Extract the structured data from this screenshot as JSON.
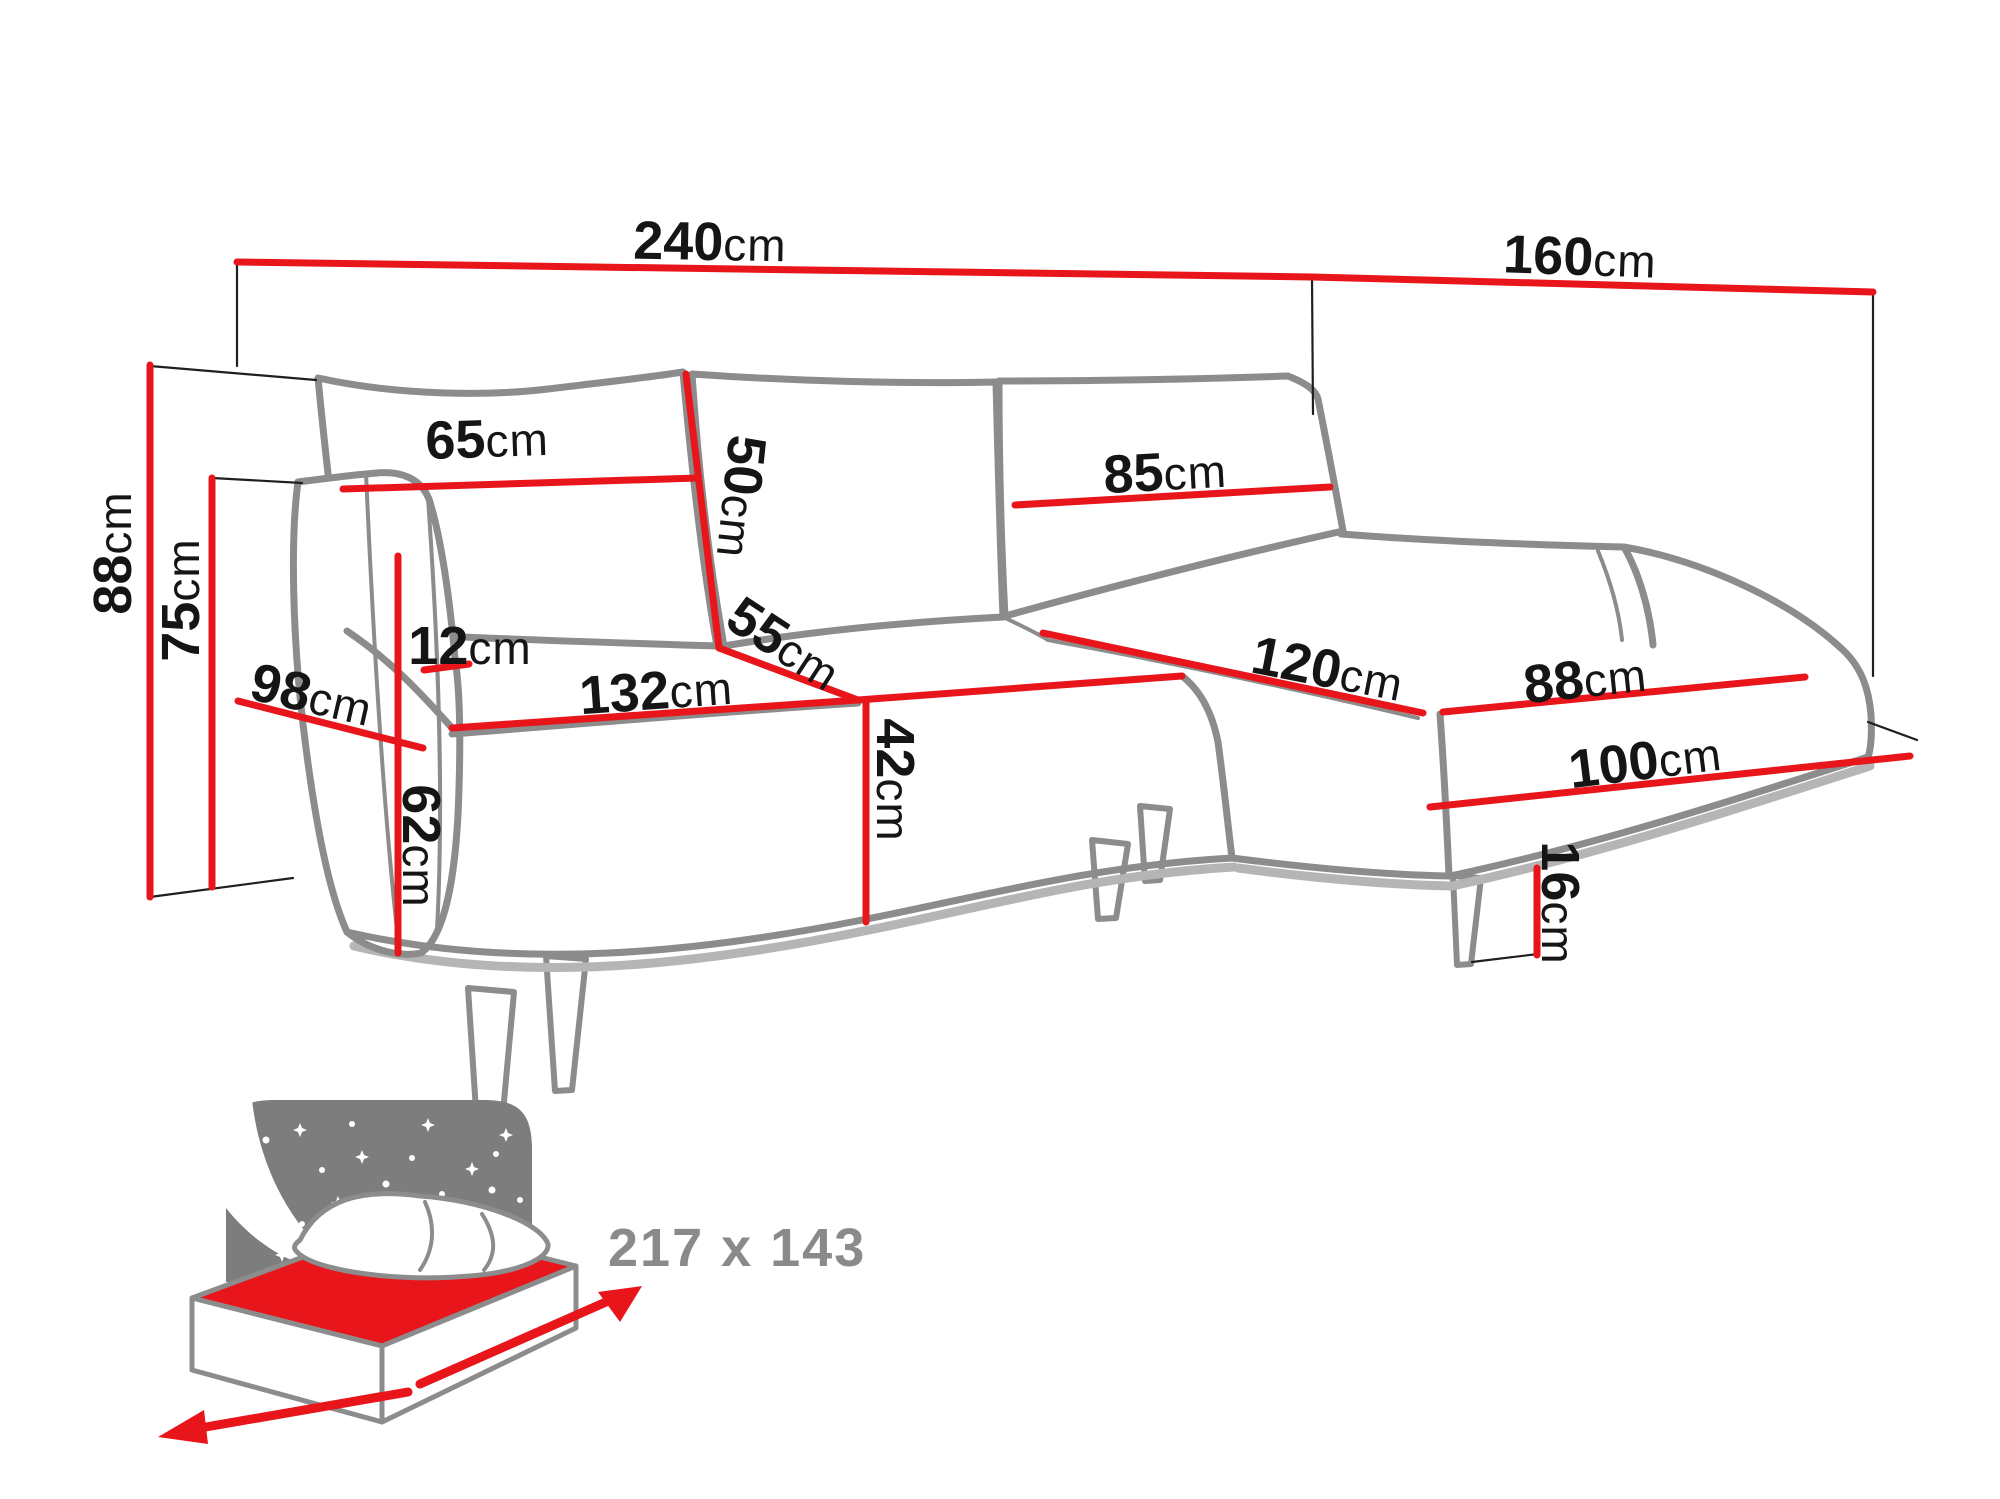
{
  "colors": {
    "dimension_red": "#e8151b",
    "outline_gray": "#8c8c8c",
    "thin_line_black": "#1f1f1f",
    "label_black": "#151515",
    "icon_gray": "#7d7d7d",
    "sleep_text_gray": "#8a8a8a",
    "background": "#ffffff"
  },
  "dimensions": {
    "total_width": {
      "value": "240",
      "unit": "cm"
    },
    "chaise_total_depth": {
      "value": "160",
      "unit": "cm"
    },
    "overall_height": {
      "value": "88",
      "unit": "cm"
    },
    "backrest_height": {
      "value": "75",
      "unit": "cm"
    },
    "left_back_cushion_width": {
      "value": "65",
      "unit": "cm"
    },
    "back_cushion_height": {
      "value": "50",
      "unit": "cm"
    },
    "right_back_cushion_width": {
      "value": "85",
      "unit": "cm"
    },
    "armrest_top_width": {
      "value": "12",
      "unit": "cm"
    },
    "armrest_depth": {
      "value": "98",
      "unit": "cm"
    },
    "armrest_height": {
      "value": "62",
      "unit": "cm"
    },
    "seat_width": {
      "value": "132",
      "unit": "cm"
    },
    "seat_depth": {
      "value": "55",
      "unit": "cm"
    },
    "seat_height": {
      "value": "42",
      "unit": "cm"
    },
    "chaise_seat_width": {
      "value": "120",
      "unit": "cm"
    },
    "chaise_seat_depth": {
      "value": "88",
      "unit": "cm"
    },
    "chaise_outer_length": {
      "value": "100",
      "unit": "cm"
    },
    "leg_height": {
      "value": "16",
      "unit": "cm"
    }
  },
  "sleeping_area": {
    "size_label": "217 x 143"
  }
}
